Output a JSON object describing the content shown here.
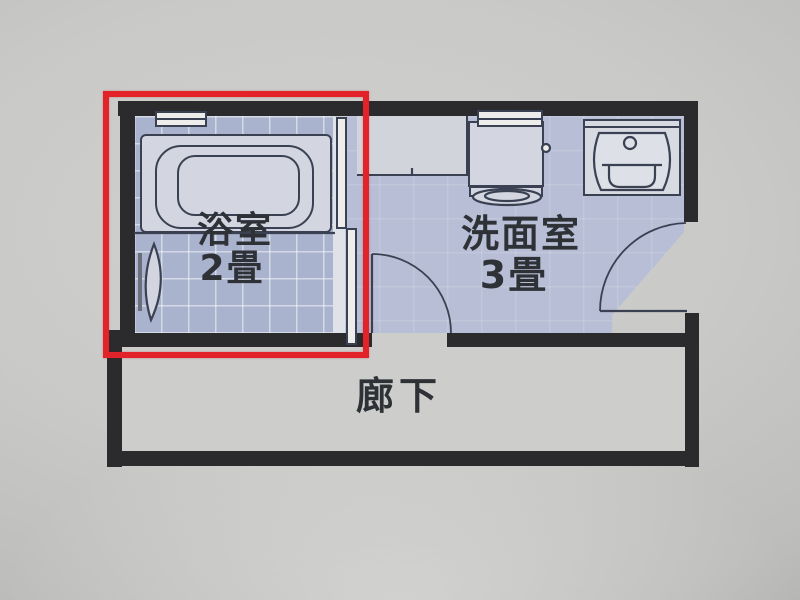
{
  "floorplan": {
    "rooms": {
      "bathroom": {
        "name": "浴室",
        "size": "2畳"
      },
      "washroom": {
        "name": "洗面室",
        "size": "3畳"
      },
      "hallway": {
        "name": "廊下"
      }
    },
    "highlight": {
      "shape": "rectangle",
      "target": "bathroom"
    },
    "fixtures": [
      "bathtub",
      "folding-door",
      "sliding-door",
      "window",
      "laundry-counter",
      "washing-machine-pan",
      "washbasin",
      "door-swing-right",
      "door-swing-bottom"
    ],
    "colors": {
      "wall": "#2b2b2d",
      "fixture_line": "#3a4152",
      "fixture_fill": "#d3d6e0",
      "window_white": "#ededeb",
      "bathroom_tile": "#a9b3ce",
      "washroom_floor": "#b7bed5",
      "hallway_floor": "#cdcecc",
      "label_text": "#2e3136",
      "highlight_red": "#e2242a",
      "paper": "#c6c6c4"
    }
  }
}
